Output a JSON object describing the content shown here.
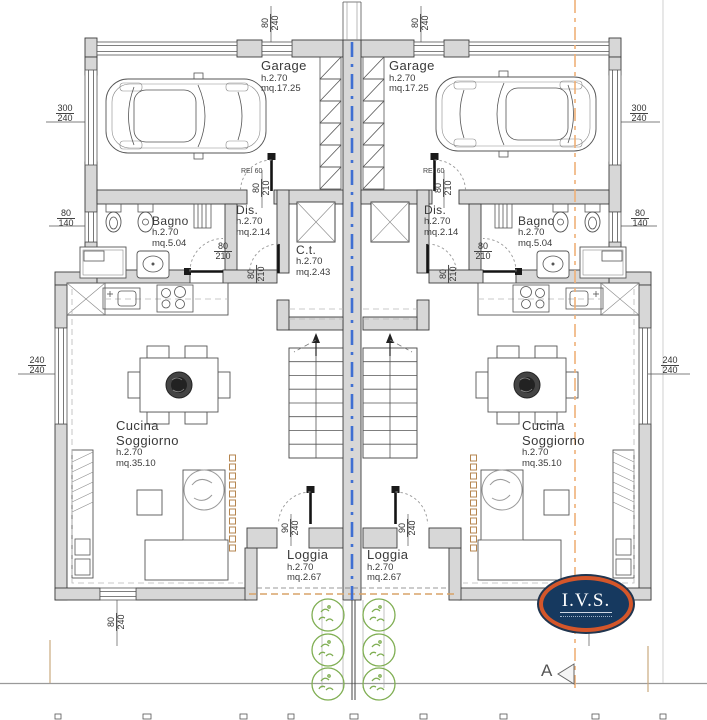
{
  "colors": {
    "wall_fill": "#d7d7d7",
    "axis_blue": "#3f6fd2",
    "section_orange": "#eeb078",
    "plant_green": "#7fae52",
    "logo_ring": "#d4562a",
    "logo_fill": "#16395f"
  },
  "units": {
    "left": {
      "garage": {
        "name": "Garage",
        "height": "h.2.70",
        "area": "mq.17.25"
      },
      "bagno": {
        "name": "Bagno",
        "height": "h.2.70",
        "area": "mq.5.04"
      },
      "dis": {
        "name": "Dis.",
        "height": "h.2.70",
        "area": "mq.2.14"
      },
      "cucina": {
        "line1": "Cucina",
        "line2": "Soggiorno",
        "height": "h.2.70",
        "area": "mq.35.10"
      },
      "loggia": {
        "name": "Loggia",
        "height": "h.2.70",
        "area": "mq.2.67"
      },
      "fire_door_label": "REI 60"
    },
    "right": {
      "garage": {
        "name": "Garage",
        "height": "h.2.70",
        "area": "mq.17.25"
      },
      "bagno": {
        "name": "Bagno",
        "height": "h.2.70",
        "area": "mq.5.04"
      },
      "dis": {
        "name": "Dis.",
        "height": "h.2.70",
        "area": "mq.2.14"
      },
      "cucina": {
        "line1": "Cucina",
        "line2": "Soggiorno",
        "height": "h.2.70",
        "area": "mq.35.10"
      },
      "loggia": {
        "name": "Loggia",
        "height": "h.2.70",
        "area": "mq.2.67"
      },
      "fire_door_label": "REI 60"
    }
  },
  "shared": {
    "ct": {
      "name": "C.t.",
      "height": "h.2.70",
      "area": "mq.2.43"
    }
  },
  "dims": {
    "top_window_left": {
      "w": "80",
      "h": "240"
    },
    "top_window_right": {
      "w": "80",
      "h": "240"
    },
    "garage_window_left": {
      "w": "300",
      "h": "240"
    },
    "garage_window_right": {
      "w": "300",
      "h": "240"
    },
    "bagno_window_left": {
      "w": "80",
      "h": "140"
    },
    "bagno_window_right": {
      "w": "80",
      "h": "140"
    },
    "living_window_left": {
      "w": "240",
      "h": "240"
    },
    "living_window_right": {
      "w": "240",
      "h": "240"
    },
    "garage_door_left": {
      "w": "80",
      "h": "210"
    },
    "garage_door_right": {
      "w": "80",
      "h": "210"
    },
    "bagno_door_left": {
      "w": "80",
      "h": "210"
    },
    "bagno_door_right": {
      "w": "80",
      "h": "210"
    },
    "hall_door_left": {
      "w": "80",
      "h": "210"
    },
    "hall_door_right": {
      "w": "80",
      "h": "210"
    },
    "loggia_door_left": {
      "w": "90",
      "h": "240"
    },
    "loggia_door_right": {
      "w": "90",
      "h": "240"
    },
    "bottom_window_left": {
      "w": "80",
      "h": "240"
    },
    "bottom_window_right": {
      "w": "80",
      "h": "240"
    }
  },
  "logo": {
    "text": "I.V.S."
  },
  "section": {
    "label": "A"
  }
}
